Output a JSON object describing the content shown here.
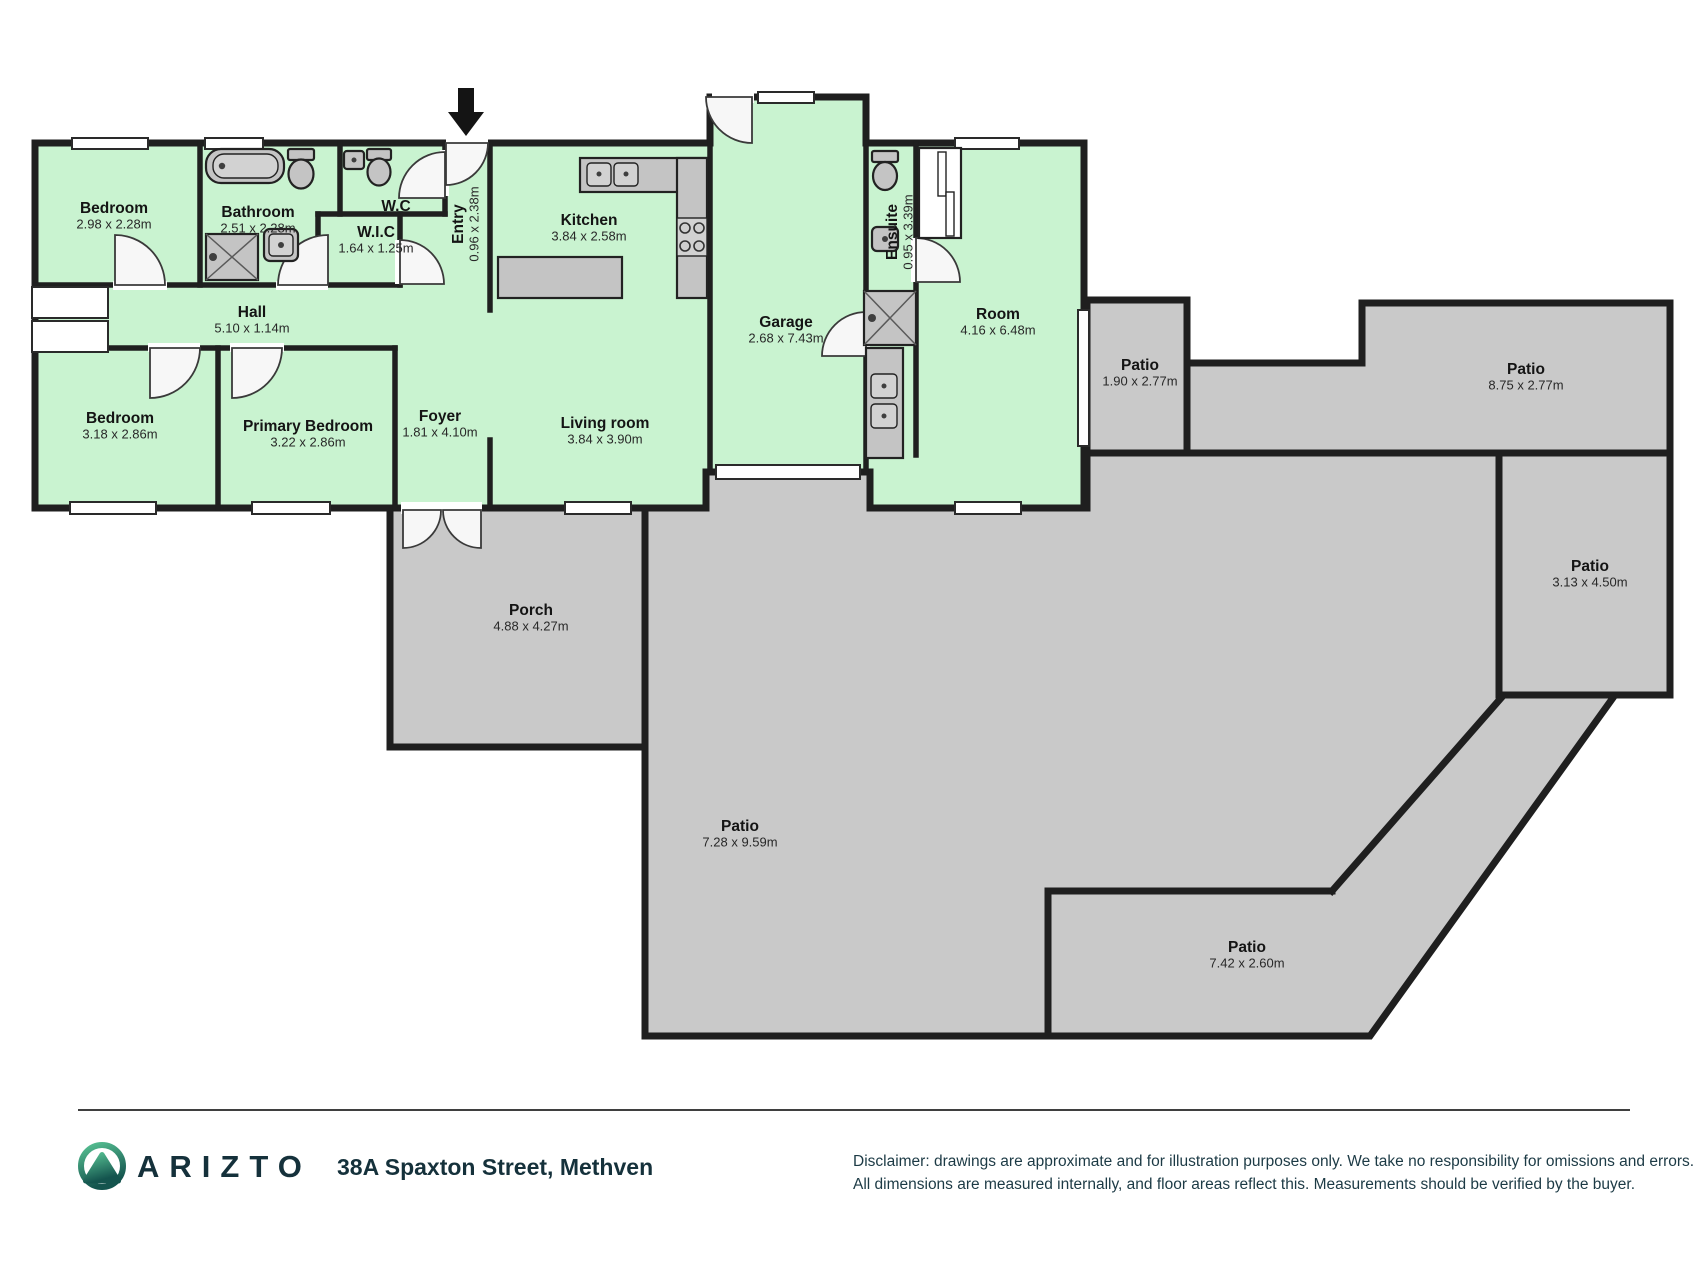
{
  "meta": {
    "title": "Floor plan - 38A Spaxton Street, Methven"
  },
  "colors": {
    "room_fill": "#c9f3d0",
    "patio_fill": "#c9c9c9",
    "wall": "#1f1f1f",
    "fixture_fill": "#c4c4c4",
    "brand_dark": "#15313b",
    "logo_green_light": "#57c193",
    "logo_green_dark": "#14544e"
  },
  "icons": [
    "entry-arrow-icon",
    "bathtub-icon",
    "toilet-icon",
    "shower-icon",
    "sink-icon",
    "kitchen-sink-icon",
    "stove-icon",
    "laundry-sink-icon",
    "closet-icon",
    "window-icon",
    "door-swing-icon",
    "garage-door-icon",
    "arizto-logo"
  ],
  "rooms": [
    {
      "id": "bedroom-1",
      "name": "Bedroom",
      "dims": "2.98 x 2.28m",
      "x": 114,
      "y": 213,
      "rot": 0
    },
    {
      "id": "bathroom",
      "name": "Bathroom",
      "dims": "2.51 x 2.28m",
      "x": 258,
      "y": 217,
      "rot": 0
    },
    {
      "id": "wc",
      "name": "W.C",
      "dims": "",
      "x": 396,
      "y": 211,
      "rot": 0
    },
    {
      "id": "wic",
      "name": "W.I.C",
      "dims": "1.64 x 1.25m",
      "x": 376,
      "y": 237,
      "rot": 0
    },
    {
      "id": "entry",
      "name": "Entry",
      "dims": "0.96 x 2.38m",
      "x": 463,
      "y": 224,
      "rot": -90
    },
    {
      "id": "kitchen",
      "name": "Kitchen",
      "dims": "3.84 x 2.58m",
      "x": 589,
      "y": 225,
      "rot": 0
    },
    {
      "id": "hall",
      "name": "Hall",
      "dims": "5.10 x 1.14m",
      "x": 252,
      "y": 317,
      "rot": 0
    },
    {
      "id": "garage",
      "name": "Garage",
      "dims": "2.68 x 7.43m",
      "x": 786,
      "y": 327,
      "rot": 0
    },
    {
      "id": "living-room",
      "name": "Living room",
      "dims": "3.84 x 3.90m",
      "x": 605,
      "y": 428,
      "rot": 0
    },
    {
      "id": "ensuite",
      "name": "Ensuite",
      "dims": "0.95 x 3.39m",
      "x": 897,
      "y": 232,
      "rot": -90
    },
    {
      "id": "room",
      "name": "Room",
      "dims": "4.16 x 6.48m",
      "x": 998,
      "y": 319,
      "rot": 0
    },
    {
      "id": "bedroom-2",
      "name": "Bedroom",
      "dims": "3.18 x 2.86m",
      "x": 120,
      "y": 423,
      "rot": 0
    },
    {
      "id": "primary-bedroom",
      "name": "Primary Bedroom",
      "dims": "3.22 x 2.86m",
      "x": 308,
      "y": 431,
      "rot": 0
    },
    {
      "id": "foyer",
      "name": "Foyer",
      "dims": "1.81 x 4.10m",
      "x": 440,
      "y": 421,
      "rot": 0
    },
    {
      "id": "porch",
      "name": "Porch",
      "dims": "4.88 x 4.27m",
      "x": 531,
      "y": 615,
      "rot": 0
    },
    {
      "id": "patio-small",
      "name": "Patio",
      "dims": "1.90 x 2.77m",
      "x": 1140,
      "y": 370,
      "rot": 0
    },
    {
      "id": "patio-top-right",
      "name": "Patio",
      "dims": "8.75 x 2.77m",
      "x": 1526,
      "y": 374,
      "rot": 0
    },
    {
      "id": "patio-right",
      "name": "Patio",
      "dims": "3.13 x 4.50m",
      "x": 1590,
      "y": 571,
      "rot": 0
    },
    {
      "id": "patio-large",
      "name": "Patio",
      "dims": "7.28 x 9.59m",
      "x": 740,
      "y": 831,
      "rot": 0
    },
    {
      "id": "patio-bottom-right",
      "name": "Patio",
      "dims": "7.42 x 2.60m",
      "x": 1247,
      "y": 952,
      "rot": 0
    }
  ],
  "footer": {
    "brand": "ARIZTO",
    "address": "38A Spaxton Street, Methven",
    "disclaimer_line1": "Disclaimer: drawings are approximate and for illustration purposes only. We take no responsibility for omissions and errors.",
    "disclaimer_line2": "All dimensions are measured internally, and floor areas reflect this. Measurements should be verified by the buyer."
  }
}
